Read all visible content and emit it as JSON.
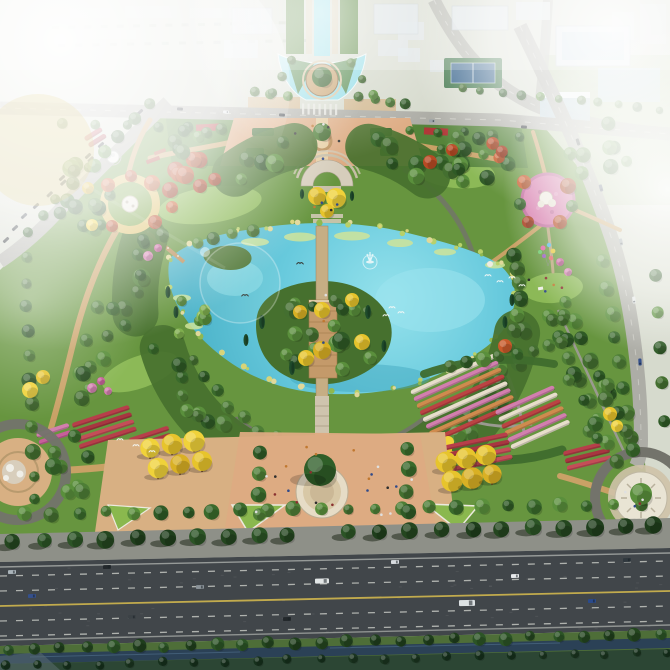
{
  "scene": {
    "title": "Aerial rendering of a landscaped urban park with a central lake",
    "type": "architectural visualization, bird's-eye view",
    "setting": "hazy daytime; surrounding city blocks and fields fade into white fog at the top and right edges; lens flares over the west lawns",
    "landmarks": [
      {
        "name": "north-boulevard",
        "description": "tree-lined canal axis leading from the city into a chalice-shaped fountain pool with a circular wooden deck and single large tree"
      },
      {
        "name": "north-entrance-plaza",
        "description": "paved entry plaza on the axis with clipped hedges, red flower strips and two golden tree groups"
      },
      {
        "name": "amphitheater-terrace",
        "description": "semicircular stepped terrace with golden trees overlooking the lake"
      },
      {
        "name": "central-axis-walkway",
        "description": "narrow walkway/bridge running north-south across the lake and wooded island"
      },
      {
        "name": "terraced-island-structure",
        "description": "stepped tan terraces on the island planted with alternating yellow and green trees"
      },
      {
        "name": "lake",
        "description": "irregular turquoise lake with lily pads, reeds, a fountain jet and white egrets"
      },
      {
        "name": "lakeside-boardwalk",
        "description": "small timber deck reaching into the northwest lobe of the lake"
      },
      {
        "name": "perimeter-tree-ring",
        "description": "dense circular band of trees enclosing the lake"
      },
      {
        "name": "west-garden-circle",
        "description": "circular autumn garden with yellow sand ring path, white rock sculpture, domed pavilion and red-orange maples"
      },
      {
        "name": "east-flower-circle",
        "description": "pink flower carpet circle with white rock group, colourful balloons and a picnic lawn"
      },
      {
        "name": "rose-parterre-garden",
        "description": "southeast garden of striped flower beds in white, pink, orange and red between curved hedges"
      },
      {
        "name": "red-flower-beds",
        "description": "bands of red and pink bedding flowers flanking the south lawns"
      },
      {
        "name": "golden-tree-groves",
        "description": "two mirrored bosques of golden-leaved trees on paved pads south of the lake"
      },
      {
        "name": "south-plaza",
        "description": "large paved plaza on the axis with a circular stone planter holding one large tree and many strolling visitors"
      },
      {
        "name": "southwest-circle-plaza",
        "description": "circular plaza with white sculpture group and ring paths, partially out of frame"
      },
      {
        "name": "southeast-circle-plaza",
        "description": "circular stone-paved plaza with a single central tree and dark ring road"
      },
      {
        "name": "boundary-roads",
        "description": "gray city roads around the park with parked and moving cars"
      },
      {
        "name": "highway",
        "description": "wide multi-lane highway along the bottom with yellow median line, dashed white lanes, cars and two trucks"
      },
      {
        "name": "waterfront-strip",
        "description": "row of trees and a dark drainage canal between the highway and the bottom edge"
      },
      {
        "name": "city-district",
        "description": "foggy white mid-rise and glass buildings, street tree rows and a tennis court at the top of the frame"
      },
      {
        "name": "wildlife",
        "description": "white egrets over the lake and lawns, dark birds above the water"
      }
    ]
  },
  "palette": {
    "base_outskirts": "#d6dacd",
    "fog": "#f4f6f1",
    "park_green": "#67953f",
    "park_green_dark": "#46702e",
    "meadow": "#8cb957",
    "lake": "#5fc5d8",
    "lake_light": "#93dde7",
    "lake_deep": "#3fa3bd",
    "canal": "#2b4156",
    "verge": "#4e6e38",
    "road_city": "#adada6",
    "road_highway": "#41464a",
    "sidewalk": "#8e9088",
    "lane_white": "#d4d6d0",
    "lane_yellow": "#c9b14e",
    "path_tan": "#c9a166",
    "plaza_tan": "#d8b083",
    "plaza_pink": "#ddab82",
    "ring_path": "#73736b",
    "stone_white": "#e9e4d4",
    "wood_deck": "#b98d58",
    "building": "#dde4e8",
    "building_glass": "#bcd2dc",
    "tree_dark": "#23481f",
    "cypress": "#1e4a2b",
    "flower_red": "#b73f4a",
    "flower_red_dark": "#a83640",
    "flower_red_light": "#c44e58",
    "flower_pink": "#d27fae",
    "flower_magenta": "#c75f9a",
    "flower_white": "#e7decb",
    "flower_orange": "#cf8b4e",
    "bird_white": "#f4f8f6",
    "tree_greens": [
      "#3a6a2c",
      "#4e7e36",
      "#2f5a26",
      "#5a8f3c",
      "#446f30"
    ],
    "tree_greens_dark": [
      "#24461f",
      "#2c5426",
      "#1f3e1c"
    ],
    "tree_yellow": [
      "#e7c42c",
      "#f0d23a",
      "#d9b024"
    ],
    "tree_red": [
      "#b84a24",
      "#a83c1e",
      "#c85a2a"
    ],
    "rose_stripe_colors": [
      "#e7decb",
      "#d27fae",
      "#cf8b4e",
      "#bb4343"
    ],
    "car_colors": [
      "#2e3338",
      "#47506a",
      "#9aa2a8",
      "#e6e9ea",
      "#35508c"
    ]
  }
}
